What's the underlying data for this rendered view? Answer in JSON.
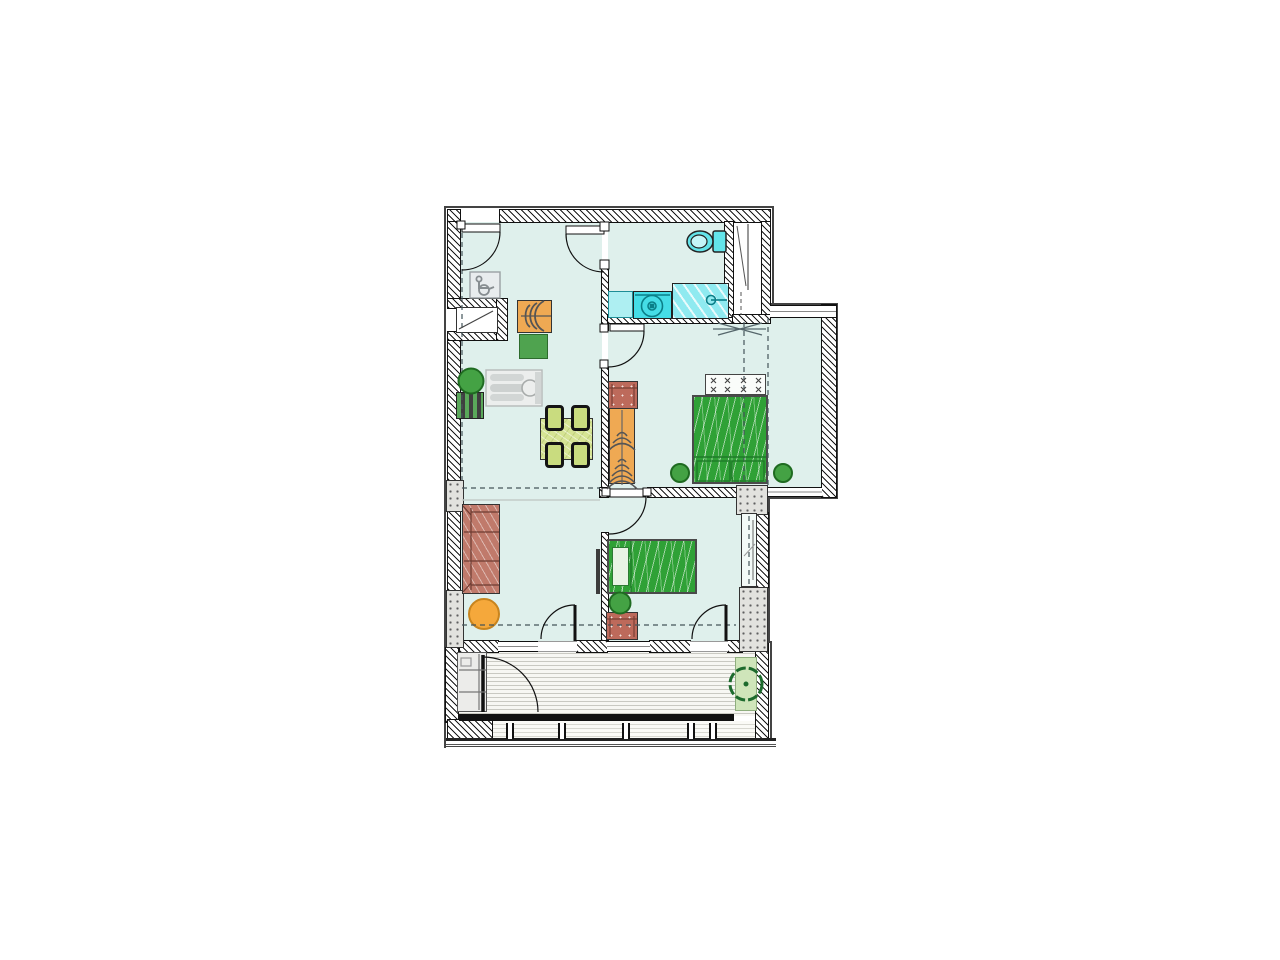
{
  "plan": {
    "kind": "apartment-floor-plan",
    "rooms": [
      {
        "name": "entry-hall"
      },
      {
        "name": "kitchen-dining"
      },
      {
        "name": "bathroom"
      },
      {
        "name": "installation-shaft"
      },
      {
        "name": "bedroom-main"
      },
      {
        "name": "bay-window"
      },
      {
        "name": "living-area"
      },
      {
        "name": "bedroom-second"
      },
      {
        "name": "balcony"
      }
    ],
    "door_count": 7,
    "window_count": 4,
    "plant_count": 5
  },
  "furniture": {
    "items": [
      "wheelchair-sign",
      "entry-closet",
      "coat-wardrobe",
      "kitchen-unit",
      "radiator-mat",
      "wheelchair-turning-figure",
      "dining-table",
      "dining-chair-x4",
      "bathroom-vanity",
      "washing-machine",
      "bathtub",
      "toilet",
      "dresser",
      "wardrobe",
      "headboard",
      "double-bed",
      "single-bed",
      "nightstand",
      "sofa",
      "pouf",
      "tv",
      "storage-cabinet",
      "planter",
      "potted-plant-x5"
    ]
  },
  "palette": {
    "floor": "#dff0ec",
    "wall-ink": "#1a1a1a",
    "pillar": "#e2e2de",
    "bed-green": "#2fa136",
    "wardrobe-orange": "#efa953",
    "dresser-red": "#bd6a5b",
    "sofa-red": "#c07a6b",
    "pouf-orange": "#f5a83b",
    "table-green": "#d6e494",
    "chair-green": "#c9dc7f",
    "plant-green": "#44a244",
    "plant-dark": "#1f6b21",
    "fixture-cyan": "#45dde6",
    "tub-cyan": "#8feaf0",
    "vanity-cyan": "#aeeff2",
    "toilet-cyan": "#63e4ea",
    "planter-green": "#cfe5ba",
    "deck": "#f7f7f3",
    "mat-dark": "#3f3f3f",
    "sign-gray": "#9aa0a3"
  }
}
